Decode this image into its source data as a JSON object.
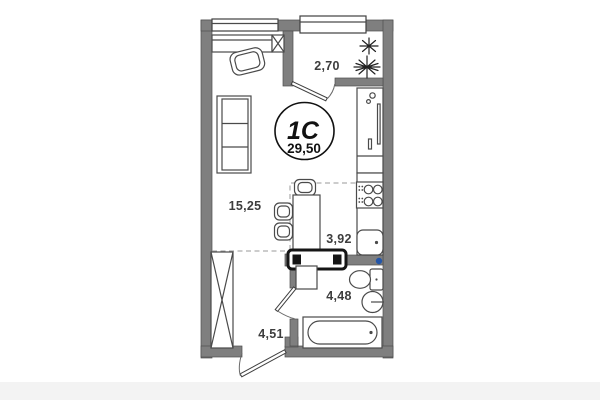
{
  "plan": {
    "unit_type": "1С",
    "total_area": "29,50",
    "rooms": {
      "living": {
        "area": "15,25"
      },
      "balcony": {
        "area": "2,70"
      },
      "kitchen": {
        "area": "3,92"
      },
      "bathroom": {
        "area": "4,48"
      },
      "hallway": {
        "area": "4,51"
      }
    },
    "colors": {
      "wall": "#7f7f7f",
      "line": "#3f3f3f",
      "riser_dot": "#2456a8",
      "footer_band": "#f3f3f3"
    }
  }
}
